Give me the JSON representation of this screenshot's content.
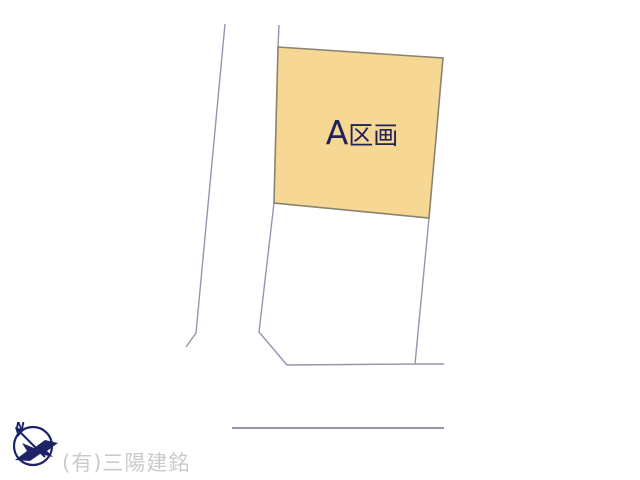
{
  "page": {
    "background": "#ffffff",
    "type_label": "land-plot-diagram"
  },
  "diagram": {
    "parcel_a": {
      "label": "A区画",
      "label_main": "A",
      "label_suffix": "区画",
      "fill": "#f6d794",
      "border_color": "#8a8370",
      "label_color": "#22225a",
      "points": "278,47 443,58 429,218 274,203"
    },
    "parcel_b": {
      "fill": "#ffffff",
      "border_color": "#9497ae",
      "points": "274,203 429,218 415,364 287,365 259,332"
    },
    "boundary_lines": {
      "color": "#9497ae",
      "road_left_points": "225,24 196,333 186,347",
      "upper_boundary_points": "279,25 278,47",
      "bottom_edge_extension_points": "415,364 444,364",
      "bottom_road_points": "232,428 444,428"
    },
    "compass": {
      "letter": "N",
      "color": "#1c2366"
    },
    "watermark": {
      "text": "(有)三陽建銘",
      "color": "#cbcbcb"
    }
  }
}
